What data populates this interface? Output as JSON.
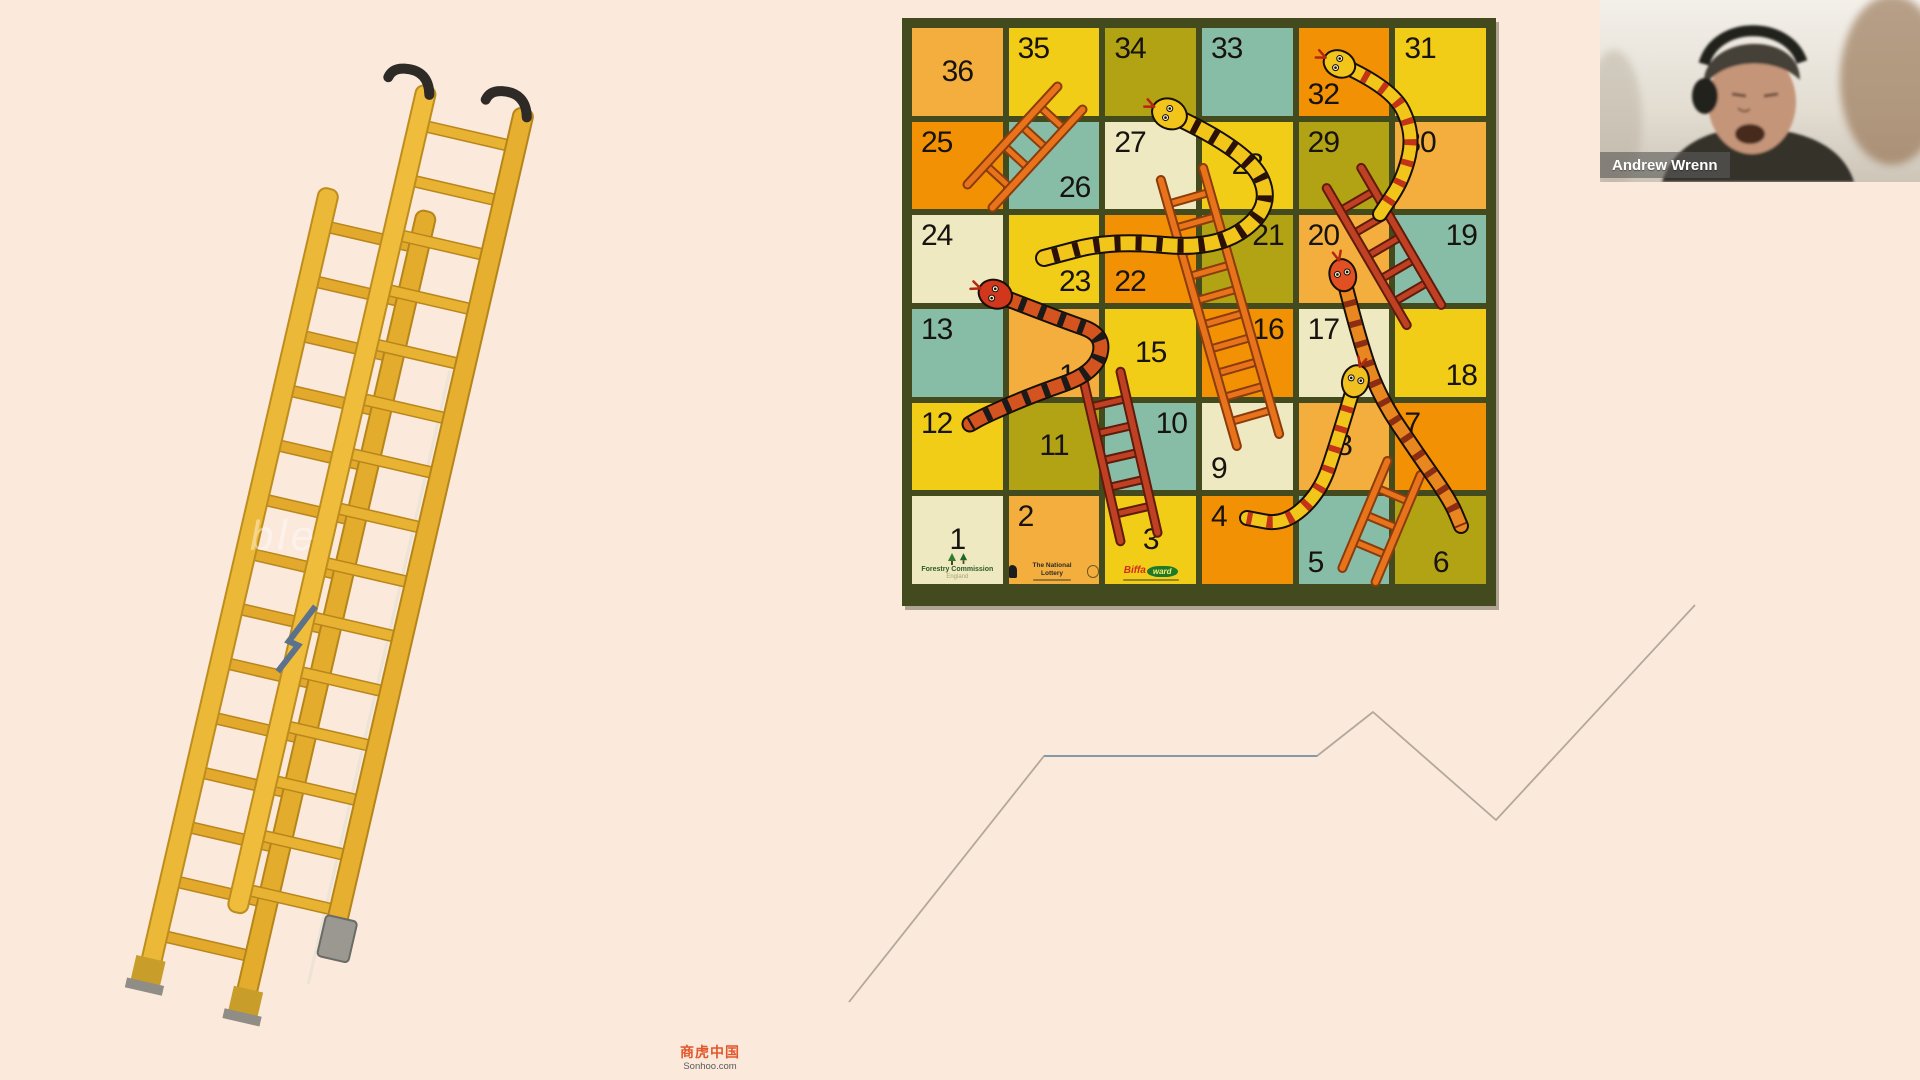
{
  "page": {
    "background": "#fbe9dc"
  },
  "webcam": {
    "participant_name": "Andrew Wrenn"
  },
  "watermark": {
    "cn": "商虎中国",
    "site": "Sonhoo.com"
  },
  "ladder_watermark": "ble",
  "board": {
    "frame_color": "#434a1d",
    "number_color": "#17130e",
    "palette": {
      "amber": "#f3ae3d",
      "yellow": "#f2cd17",
      "olive": "#b2a315",
      "teal": "#87bda7",
      "orange": "#f29104",
      "cream": "#eee9c0"
    },
    "cells": [
      {
        "n": 36,
        "color": "amber",
        "pos": "c"
      },
      {
        "n": 35,
        "color": "yellow",
        "pos": "tl"
      },
      {
        "n": 34,
        "color": "olive",
        "pos": "tl"
      },
      {
        "n": 33,
        "color": "teal",
        "pos": "tl"
      },
      {
        "n": 32,
        "color": "orange",
        "pos": "bl"
      },
      {
        "n": 31,
        "color": "yellow",
        "pos": "tl"
      },
      {
        "n": 25,
        "color": "orange",
        "pos": "tl"
      },
      {
        "n": 26,
        "color": "teal",
        "pos": "br"
      },
      {
        "n": 27,
        "color": "cream",
        "pos": "tl"
      },
      {
        "n": 28,
        "color": "yellow",
        "pos": "c"
      },
      {
        "n": 29,
        "color": "olive",
        "pos": "tl"
      },
      {
        "n": 30,
        "color": "amber",
        "pos": "tl"
      },
      {
        "n": 24,
        "color": "cream",
        "pos": "tl"
      },
      {
        "n": 23,
        "color": "yellow",
        "pos": "br"
      },
      {
        "n": 22,
        "color": "orange",
        "pos": "bl"
      },
      {
        "n": 21,
        "color": "olive",
        "pos": "tr"
      },
      {
        "n": 20,
        "color": "amber",
        "pos": "tl"
      },
      {
        "n": 19,
        "color": "teal",
        "pos": "tr"
      },
      {
        "n": 13,
        "color": "teal",
        "pos": "tl"
      },
      {
        "n": 14,
        "color": "amber",
        "pos": "br"
      },
      {
        "n": 15,
        "color": "yellow",
        "pos": "c"
      },
      {
        "n": 16,
        "color": "orange",
        "pos": "tr"
      },
      {
        "n": 17,
        "color": "cream",
        "pos": "tl"
      },
      {
        "n": 18,
        "color": "yellow",
        "pos": "br"
      },
      {
        "n": 12,
        "color": "yellow",
        "pos": "tl"
      },
      {
        "n": 11,
        "color": "olive",
        "pos": "c"
      },
      {
        "n": 10,
        "color": "teal",
        "pos": "tr"
      },
      {
        "n": 9,
        "color": "cream",
        "pos": "bl"
      },
      {
        "n": 8,
        "color": "amber",
        "pos": "c"
      },
      {
        "n": 7,
        "color": "orange",
        "pos": "tl"
      },
      {
        "n": 1,
        "color": "cream",
        "pos": "c"
      },
      {
        "n": 2,
        "color": "amber",
        "pos": "tl"
      },
      {
        "n": 3,
        "color": "yellow",
        "pos": "c"
      },
      {
        "n": 4,
        "color": "orange",
        "pos": "tl"
      },
      {
        "n": 5,
        "color": "teal",
        "pos": "bl"
      },
      {
        "n": 6,
        "color": "olive",
        "pos": "bc"
      }
    ],
    "sponsors": {
      "forestry_line1": "Forestry Commission",
      "forestry_line2": "England",
      "lottery": "The National Lottery",
      "biffa_red": "Biffa",
      "biffa_green": "ward"
    },
    "ladder_colors": {
      "orange": {
        "main": "#e8731a",
        "dark": "#8a3c0d"
      },
      "crimson": {
        "main": "#c04024",
        "dark": "#5f1c0a"
      }
    },
    "ladders": [
      {
        "xy": [
          68,
          168,
          158,
          70
        ],
        "w": 34,
        "color": "orange"
      },
      {
        "xy": [
          270,
          146,
          346,
          412
        ],
        "w": 44,
        "color": "orange"
      },
      {
        "xy": [
          432,
          150,
          512,
          287
        ],
        "w": 40,
        "color": "crimson"
      },
      {
        "xy": [
          190,
          348,
          227,
          509
        ],
        "w": 38,
        "color": "crimson"
      },
      {
        "xy": [
          447,
          547,
          492,
          440
        ],
        "w": 36,
        "color": "orange"
      }
    ],
    "snakes": [
      {
        "pts": [
          [
            262,
            88
          ],
          [
            335,
            122
          ],
          [
            362,
            178
          ],
          [
            305,
            222
          ],
          [
            200,
            212
          ],
          [
            132,
            230
          ]
        ],
        "body": "#f2c51a",
        "band": "#2b1007",
        "head": "#f2c51a",
        "bw": 14
      },
      {
        "pts": [
          [
            88,
            268
          ],
          [
            150,
            292
          ],
          [
            193,
            307
          ],
          [
            183,
            345
          ],
          [
            120,
            367
          ],
          [
            72,
            388
          ],
          [
            58,
            396
          ]
        ],
        "body": "#d4541f",
        "band": "#1a1a1a",
        "head": "#d1371c",
        "bw": 13
      },
      {
        "pts": [
          [
            432,
            38
          ],
          [
            480,
            60
          ],
          [
            502,
            105
          ],
          [
            492,
            150
          ],
          [
            468,
            186
          ]
        ],
        "body": "#f2c51a",
        "band": "#c23317",
        "head": "#f2c51a",
        "bw": 12
      },
      {
        "pts": [
          [
            432,
            252
          ],
          [
            448,
            315
          ],
          [
            468,
            370
          ],
          [
            505,
            425
          ],
          [
            538,
            472
          ],
          [
            549,
            498
          ]
        ],
        "body": "#e8871f",
        "band": "#8a2d12",
        "head": "#e05022",
        "bw": 12
      },
      {
        "pts": [
          [
            442,
            358
          ],
          [
            425,
            415
          ],
          [
            408,
            465
          ],
          [
            372,
            497
          ],
          [
            335,
            490
          ]
        ],
        "body": "#f2c51a",
        "band": "#c23317",
        "head": "#f0c020",
        "bw": 12
      }
    ]
  },
  "zigzag": {
    "points": [
      [
        849,
        1002
      ],
      [
        1044,
        756
      ],
      [
        1317,
        756
      ],
      [
        1373,
        712
      ],
      [
        1496,
        820
      ],
      [
        1695,
        605
      ]
    ],
    "gray": "#b3a89c",
    "blue": "#7b96ab",
    "blue_segment": [
      1,
      2
    ]
  }
}
